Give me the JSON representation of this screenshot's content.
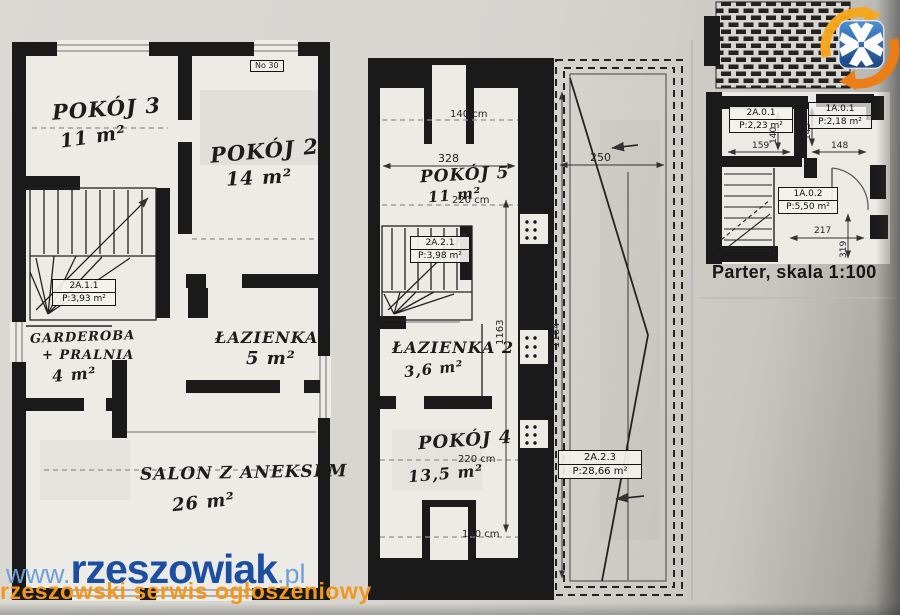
{
  "watermark": {
    "prefix": "www.",
    "brand": "rzeszowiak",
    "suffix": ".pl",
    "tagline": "rzeszowski serwis ogłoszeniowy"
  },
  "caption": "Parter, skala 1:100",
  "colors": {
    "brand_blue": "#1d4fa0",
    "brand_light_blue": "#6f9fd8",
    "brand_orange": "#f2971b",
    "logo_blue": "#2a6fc0",
    "logo_orange": "#f08418"
  },
  "floor_left": {
    "corner_tag": "No 30",
    "pokoj3_name": "POKÓJ 3",
    "pokoj3_area": "11 m²",
    "pokoj2_name": "POKÓJ 2",
    "pokoj2_area": "14 m²",
    "garderoba_name1": "GARDEROBA",
    "garderoba_name2": "+ PRALNIA",
    "garderoba_area": "4 m²",
    "lazienka_name": "ŁAZIENKA",
    "lazienka_area": "5 m²",
    "salon_name": "SALON Z ANEKSEM",
    "salon_area": "26 m²",
    "stairs_tag_id": "2A.1.1",
    "stairs_tag_area": "P:3,93 m²"
  },
  "floor_mid": {
    "pokoj5_name": "POKÓJ 5",
    "pokoj5_area": "11 m²",
    "lazienka2_name": "ŁAZIENKA 2",
    "lazienka2_area": "3,6 m²",
    "pokoj4_name": "POKÓJ 4",
    "pokoj4_area": "13,5 m²",
    "stairs_tag_id": "2A.2.1",
    "stairs_tag_area": "P:3,98 m²",
    "terrace_tag_id": "2A.2.3",
    "terrace_tag_area": "P:28,66 m²",
    "dim_door_top": "140 cm",
    "dim_width": "328",
    "dim_pokoj5_depth": "220 cm",
    "dim_pokoj4_depth": "220 cm",
    "dim_door_bottom": "140 cm",
    "dim_terrace_width": "250",
    "dim_height_left": "1163",
    "dim_height_right": "1164"
  },
  "parter": {
    "tag1_id": "2A.0.1",
    "tag1_area": "P:2,23 m²",
    "tag2_id": "1A.0.1",
    "tag2_area": "P:2,18 m²",
    "tag3_id": "1A.0.2",
    "tag3_area": "P:5,50 m²",
    "dim_w1": "159",
    "dim_h1": "140",
    "dim_w2": "148",
    "dim_h2": "145",
    "dim_w3": "217",
    "dim_h3": "319"
  }
}
